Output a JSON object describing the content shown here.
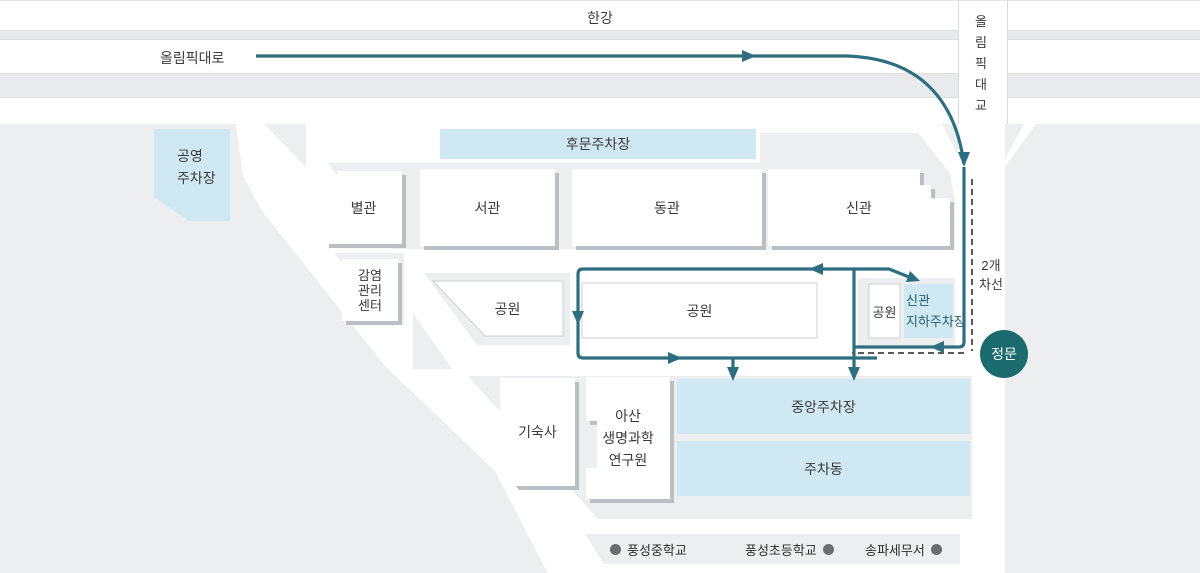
{
  "map_labels": {
    "river": "한강",
    "expressway": "올림픽대로",
    "bridge_chars": [
      "올",
      "림",
      "픽",
      "대",
      "교"
    ],
    "lanes_line1": "2개",
    "lanes_line2": "차선",
    "main_gate": "정문"
  },
  "parking": {
    "public_line1": "공영",
    "public_line2": "주차장",
    "back_gate": "후문주차장",
    "new_underground_line1": "신관",
    "new_underground_line2": "지하주차장",
    "central": "중앙주차장",
    "parking_building": "주차동"
  },
  "buildings": {
    "annex": "별관",
    "west_wing": "서관",
    "east_wing": "동관",
    "new_wing": "신관",
    "infection_line1": "감염",
    "infection_line2": "관리",
    "infection_line3": "센터",
    "dormitory": "기숙사",
    "research_line1": "아산",
    "research_line2": "생명과학",
    "research_line3": "연구원"
  },
  "parks": {
    "park1": "공원",
    "park2": "공원",
    "park3": "공원"
  },
  "legend": {
    "item1": "풍성중학교",
    "item2": "풍성초등학교",
    "item3": "송파세무서"
  },
  "colors": {
    "route": "#2d6f80",
    "gate": "#1a6a6e",
    "parking_blue": "#cfe8f2",
    "block_gray": "#eceef0"
  }
}
